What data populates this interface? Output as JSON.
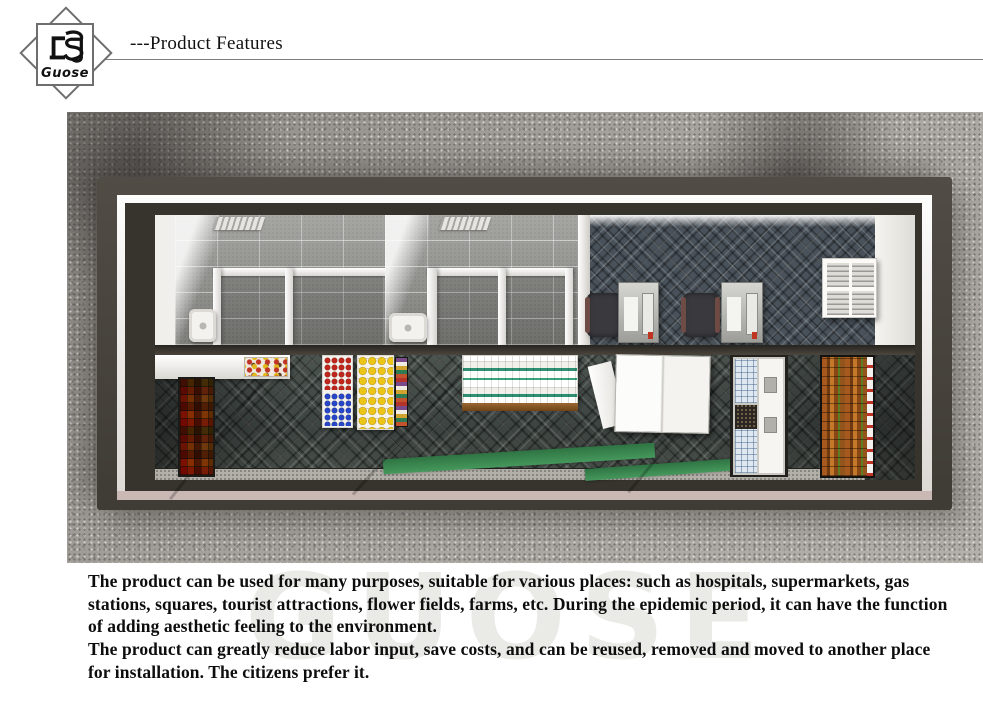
{
  "logo": {
    "brand": "Guose"
  },
  "header": {
    "title": "---Product Features"
  },
  "description": {
    "para1": "The product can be used for many purposes, suitable for various places: such as hospitals, supermarkets, gas stations, squares, tourist attractions, flower fields, farms, etc. During the epidemic period, it can have the function of adding aesthetic feeling to the environment.",
    "para2": "The product can greatly reduce labor input, save costs, and can be reused, removed and moved to another place for installation. The citizens prefer it."
  },
  "watermark": {
    "text": "GUOSE"
  },
  "palette": {
    "ground_gravel": "#a3a09b",
    "building_frame": "#45413b",
    "inner_rim": "#eceae6",
    "rim_bottom_pink": "#c9b8b4",
    "tile_wall": "#8d8d89",
    "diamond_wallpaper": "#49525a",
    "retail_floor": "#434a47",
    "green_floor_stripe": "#3c8a52",
    "shelf_red": "#c0271c",
    "shelf_blue": "#2746c8",
    "shelf_yellow": "#ecc517",
    "shelf_orange": "#b5651d"
  }
}
